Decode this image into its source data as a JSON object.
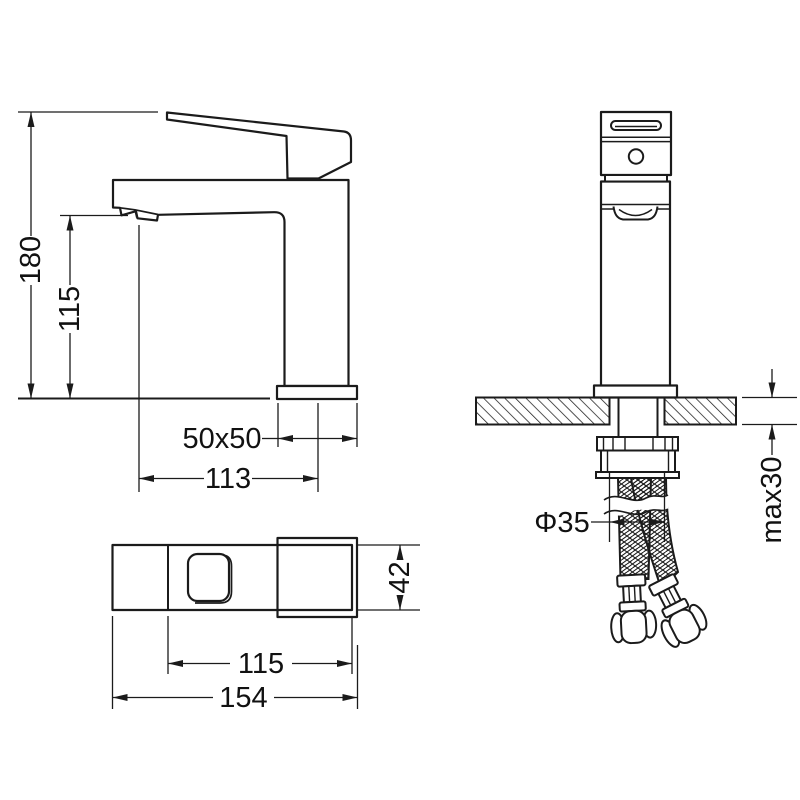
{
  "canvas": {
    "background": "#ffffff",
    "line_color": "#1b1b1b",
    "text_color": "#111111"
  },
  "drawing": {
    "kind": "faucet installation technical drawing",
    "views": {
      "side_view_dims": {
        "total_height": "180",
        "spout_height": "115",
        "base_size": "50x50",
        "spout_reach": "113"
      },
      "front_view_dims": {
        "counter_thickness_max": "max30",
        "hole_diameter": "Φ35"
      },
      "top_view_dims": {
        "body_width": "42",
        "handle_length": "115",
        "overall_length": "154"
      }
    }
  }
}
